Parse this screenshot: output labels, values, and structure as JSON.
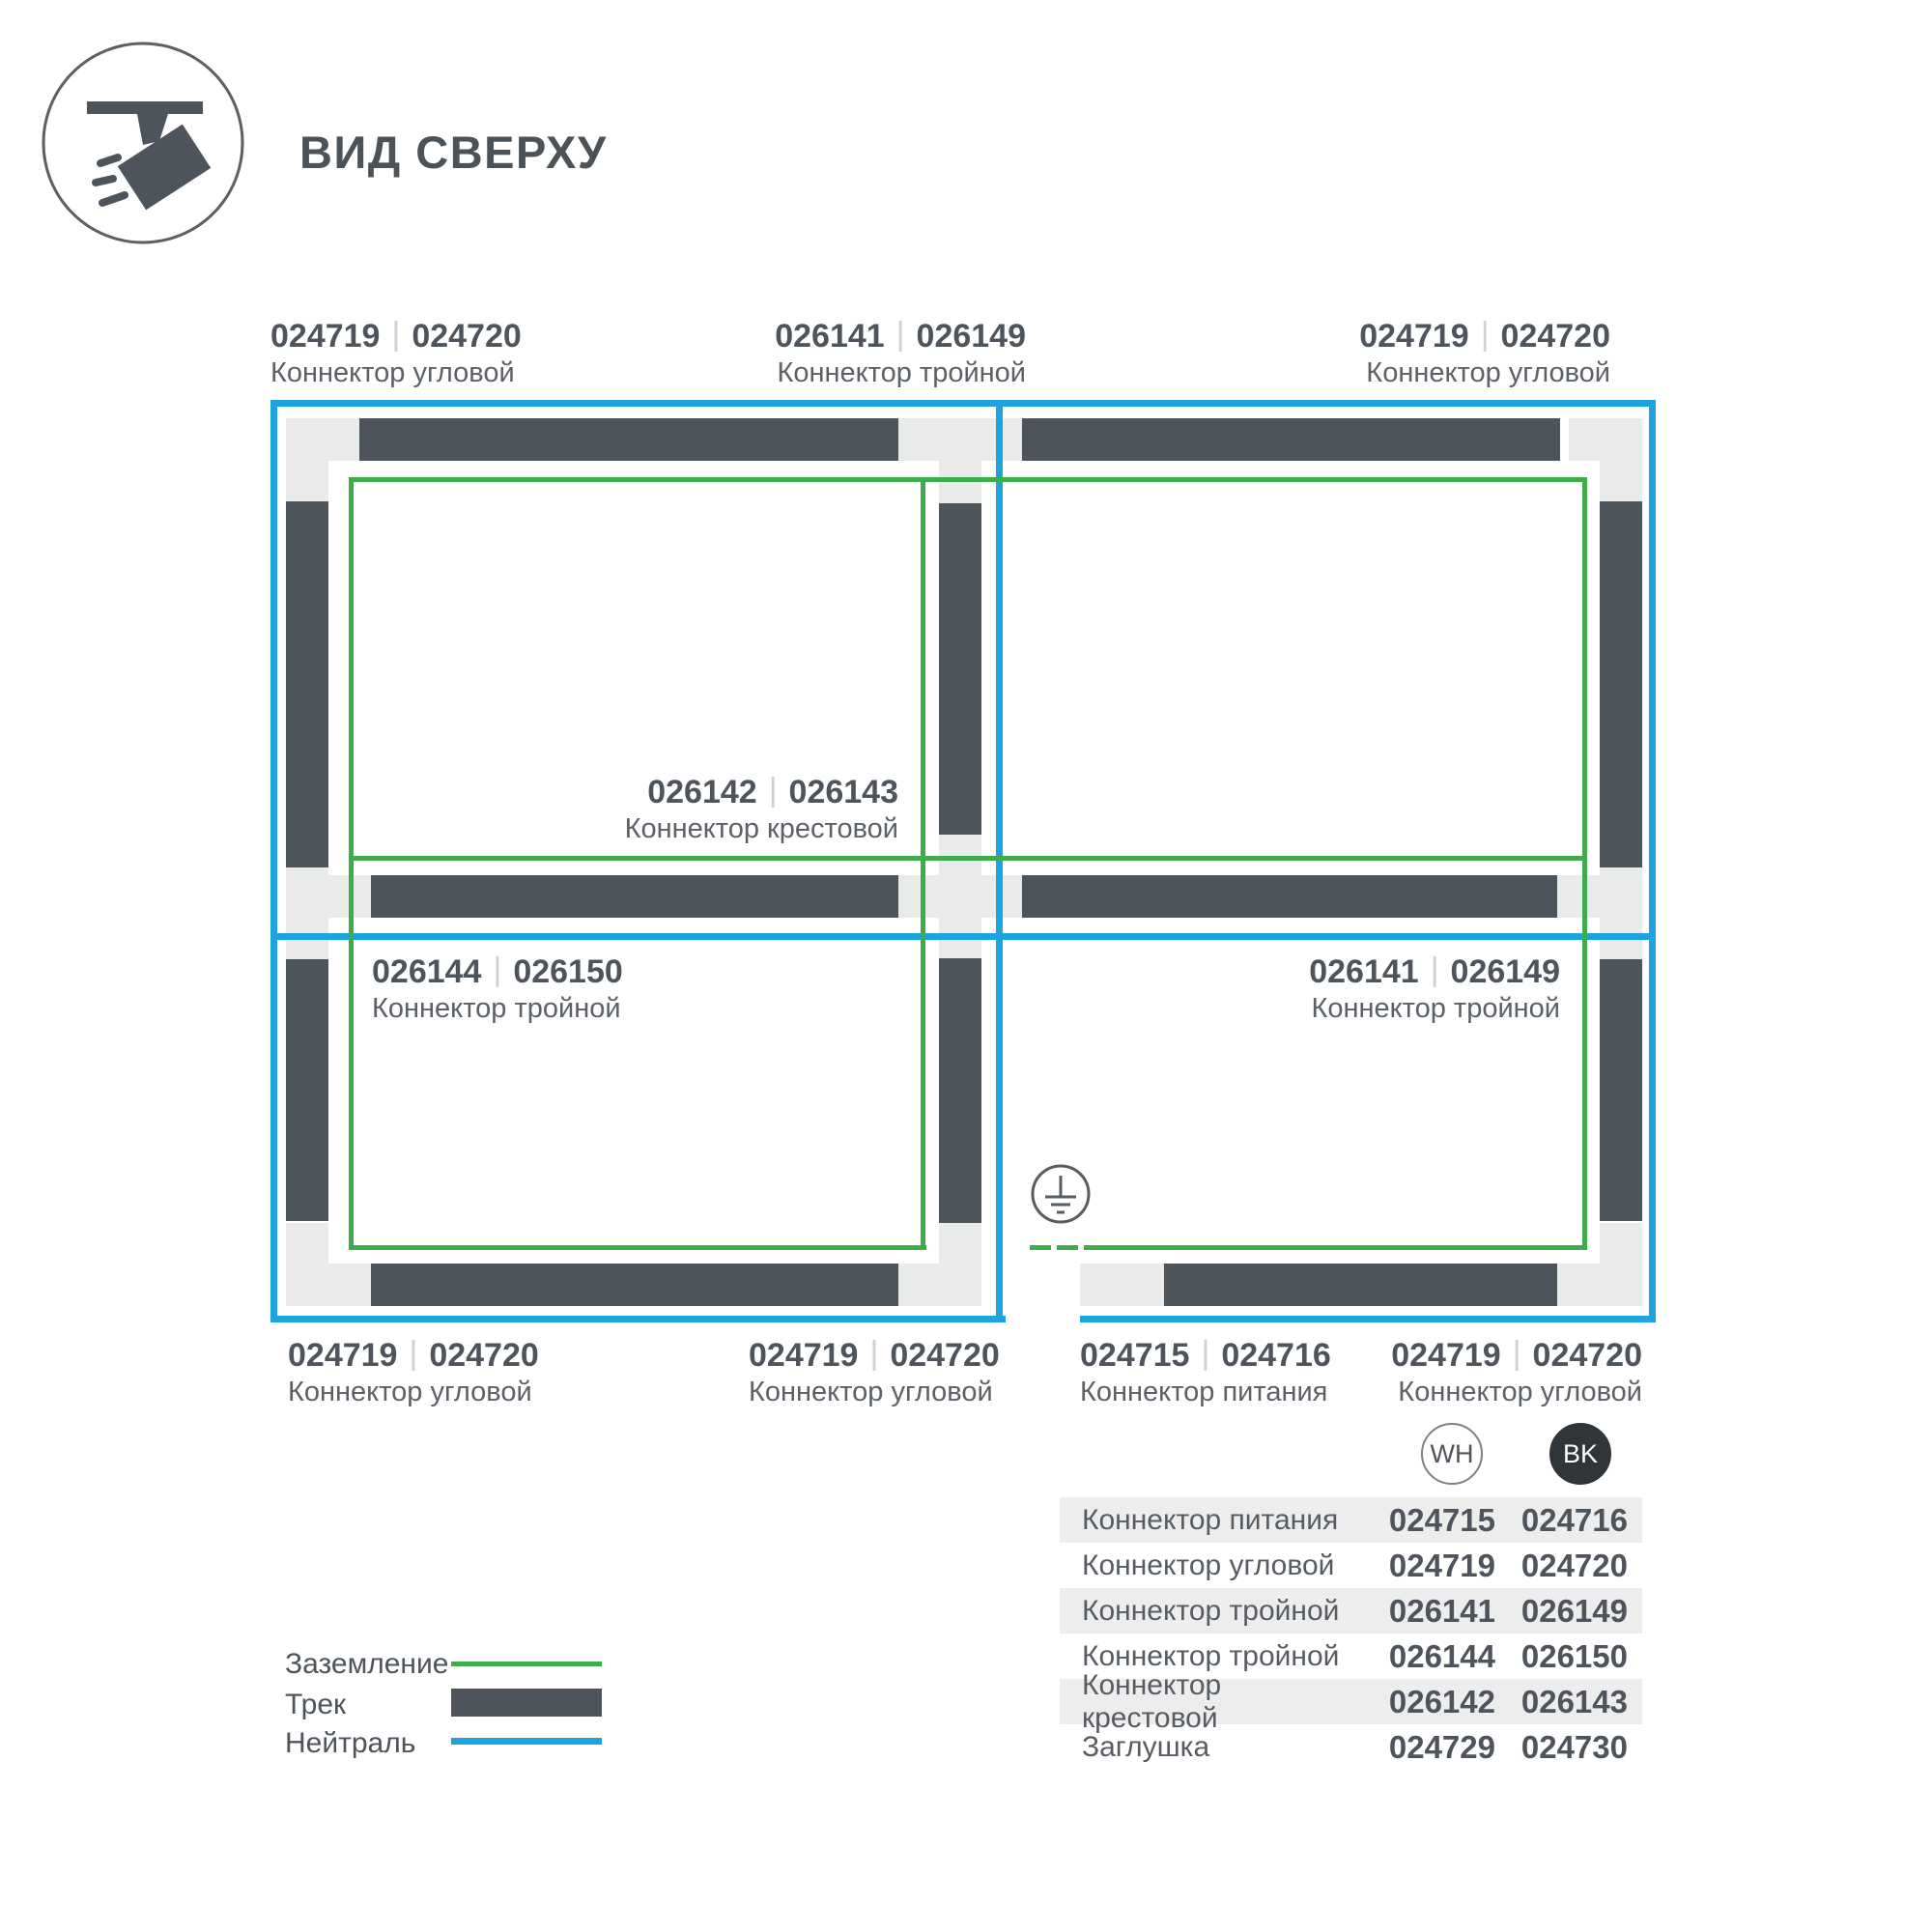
{
  "header": {
    "title": "ВИД СВЕРХУ",
    "icon": "spotlight-track-icon"
  },
  "colors": {
    "track": "#4d545b",
    "ground_green": "#3fac4c",
    "neutral_blue": "#1fa3e0",
    "connector_block": "#e9eaea",
    "table_row_alt": "#ededed",
    "bk_badge": "#30353a"
  },
  "diagram": {
    "divider": "|",
    "ground_symbol": "earth-ground-icon",
    "labels": [
      {
        "wh": "024719",
        "bk": "024720",
        "name": "Коннектор угловой"
      },
      {
        "wh": "026141",
        "bk": "026149",
        "name": "Коннектор тройной"
      },
      {
        "wh": "024719",
        "bk": "024720",
        "name": "Коннектор угловой"
      },
      {
        "wh": "026142",
        "bk": "026143",
        "name": "Коннектор крестовой"
      },
      {
        "wh": "026144",
        "bk": "026150",
        "name": "Коннектор тройной"
      },
      {
        "wh": "026141",
        "bk": "026149",
        "name": "Коннектор тройной"
      },
      {
        "wh": "024719",
        "bk": "024720",
        "name": "Коннектор угловой"
      },
      {
        "wh": "024719",
        "bk": "024720",
        "name": "Коннектор угловой"
      },
      {
        "wh": "024715",
        "bk": "024716",
        "name": "Коннектор питания"
      },
      {
        "wh": "024719",
        "bk": "024720",
        "name": "Коннектор угловой"
      }
    ]
  },
  "legend": {
    "items": [
      {
        "label": "Заземление",
        "swatch": "ground-line"
      },
      {
        "label": "Трек",
        "swatch": "track-bar"
      },
      {
        "label": "Нейтраль",
        "swatch": "neutral-line"
      }
    ]
  },
  "table": {
    "columns": [
      {
        "id": "wh",
        "label": "WH"
      },
      {
        "id": "bk",
        "label": "BK"
      }
    ],
    "rows": [
      {
        "name": "Коннектор питания",
        "wh": "024715",
        "bk": "024716"
      },
      {
        "name": "Коннектор угловой",
        "wh": "024719",
        "bk": "024720"
      },
      {
        "name": "Коннектор тройной",
        "wh": "026141",
        "bk": "026149"
      },
      {
        "name": "Коннектор тройной",
        "wh": "026144",
        "bk": "026150"
      },
      {
        "name": "Коннектор крестовой",
        "wh": "026142",
        "bk": "026143"
      },
      {
        "name": "Заглушка",
        "wh": "024729",
        "bk": "024730"
      }
    ]
  }
}
